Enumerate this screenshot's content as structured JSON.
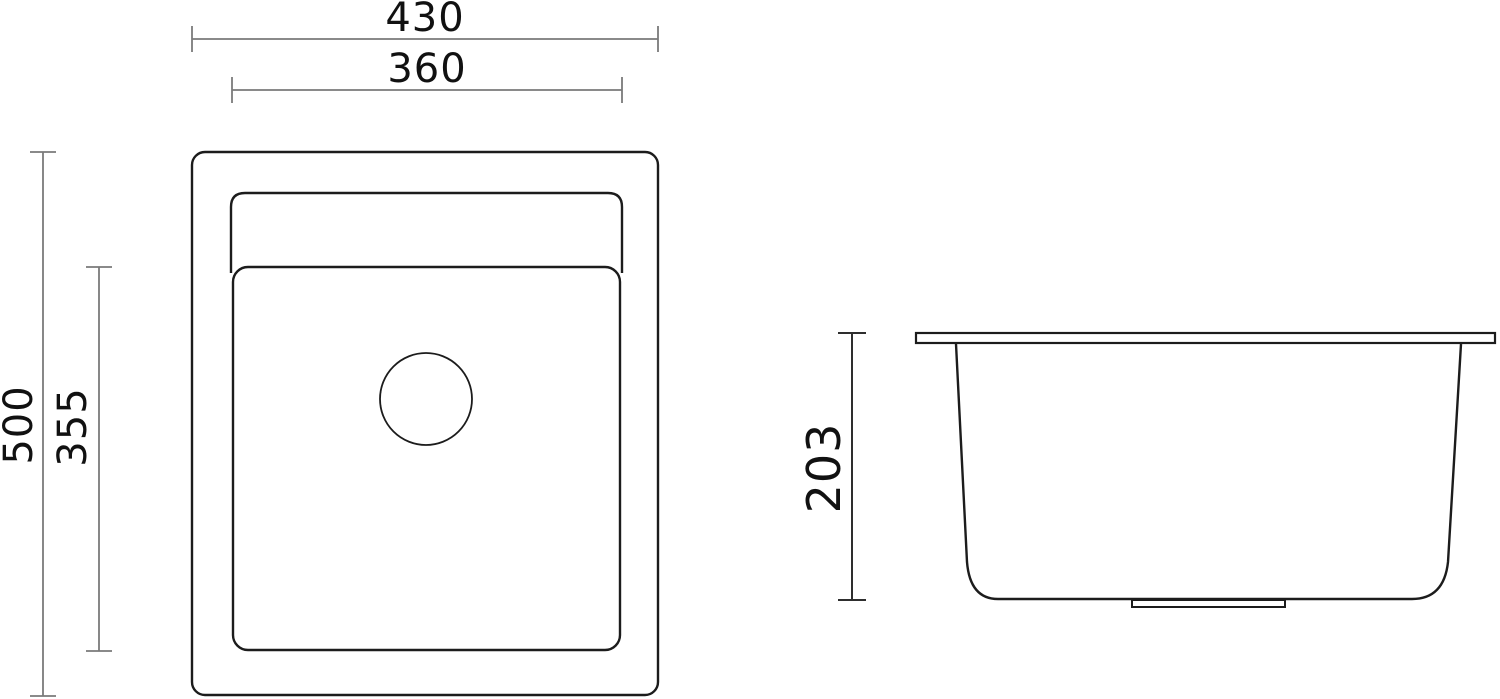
{
  "drawing": {
    "background": "#ffffff",
    "colors": {
      "outline": "#1c1c1c",
      "dim_line": "#7a7a7a",
      "dim_line_dark": "#2e2e2e",
      "label_text": "#111111"
    },
    "views": {
      "top": {
        "dimensions": {
          "outer_width": "430",
          "inner_width": "360",
          "outer_height": "500",
          "inner_height": "355"
        }
      },
      "side": {
        "dimensions": {
          "depth": "203"
        }
      }
    }
  }
}
